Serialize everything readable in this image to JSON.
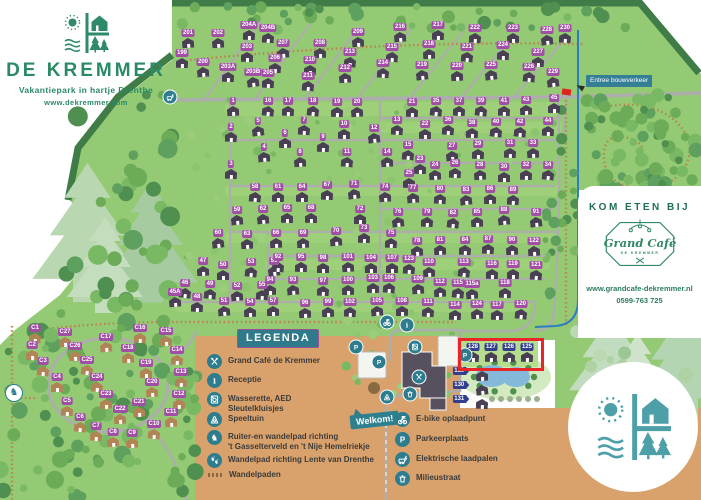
{
  "branding": {
    "logo_title": "DE KREMMER",
    "logo_subtitle": "Vakantiepark in hartje Drenthe",
    "logo_url": "www.dekremmer.com"
  },
  "cafe_panel": {
    "heading": "KOM ETEN BIJ",
    "logo_script": "Grand Café",
    "logo_sub": "DE KREMMER",
    "url": "www.grandcafe-dekremmer.nl",
    "phone": "0599-763 725"
  },
  "signs": {
    "welcome": "Welkom!",
    "entrance": "Entree bouwverkeer"
  },
  "legend": {
    "title": "LEGENDA",
    "items": [
      {
        "icon": "utensils-icon",
        "label": "Grand Café de Kremmer"
      },
      {
        "icon": "info-icon",
        "label": "Receptie"
      },
      {
        "icon": "washer-icon",
        "label": "Wasserette, AED\nSleutelkluisjes"
      },
      {
        "icon": "playground-icon",
        "label": "Speeltuin"
      },
      {
        "icon": "horse-icon",
        "label": "Ruiter-en wandelpad richting\n't Gasselterveld en 't Nije Hemelriekje"
      },
      {
        "icon": "footpath-icon",
        "label": "Wandelpad richting Lente van Drenthe"
      },
      {
        "icon": "trail-icon",
        "label": "Wandelpaden"
      }
    ],
    "items_right": [
      {
        "icon": "ebike-icon",
        "label": "E-bike oplaadpunt"
      },
      {
        "icon": "parking-icon",
        "label": "Parkeerplaats"
      },
      {
        "icon": "charger-icon",
        "label": "Elektrische laadpalen"
      },
      {
        "icon": "waste-icon",
        "label": "Milieustraat"
      }
    ]
  },
  "map": {
    "colors": {
      "green": "#94ca73",
      "dark_edge": "#3f7c47",
      "tan": "#d9a26c",
      "label_purple": "#a14fa5",
      "label_blue": "#333f8e",
      "house_dark": "#494153",
      "house_tan": "#b08455",
      "teal": "#2d7d8e",
      "red": "#e8262a",
      "route_blue": "#2e7fc2"
    },
    "houses": [
      [
        "199",
        182,
        58
      ],
      [
        "200",
        203,
        67
      ],
      [
        "201",
        188,
        38
      ],
      [
        "202",
        218,
        38
      ],
      [
        "203",
        247,
        52
      ],
      [
        "203A",
        228,
        72
      ],
      [
        "203B",
        253,
        77
      ],
      [
        "204A",
        249,
        30
      ],
      [
        "204B",
        268,
        33
      ],
      [
        "205",
        268,
        78
      ],
      [
        "206",
        275,
        63
      ],
      [
        "207",
        283,
        48
      ],
      [
        "208",
        320,
        48
      ],
      [
        "209",
        358,
        37
      ],
      [
        "210",
        310,
        65
      ],
      [
        "211",
        308,
        81
      ],
      [
        "212",
        345,
        73
      ],
      [
        "213",
        350,
        57
      ],
      [
        "214",
        383,
        68
      ],
      [
        "215",
        392,
        52
      ],
      [
        "216",
        400,
        32
      ],
      [
        "217",
        438,
        30
      ],
      [
        "218",
        429,
        49
      ],
      [
        "219",
        422,
        70
      ],
      [
        "220",
        457,
        71
      ],
      [
        "221",
        467,
        52
      ],
      [
        "222",
        475,
        33
      ],
      [
        "223",
        513,
        33
      ],
      [
        "224",
        503,
        50
      ],
      [
        "225",
        491,
        70
      ],
      [
        "226",
        529,
        72
      ],
      [
        "227",
        538,
        57
      ],
      [
        "228",
        547,
        35
      ],
      [
        "229",
        553,
        77
      ],
      [
        "230",
        565,
        33
      ],
      [
        "1",
        233,
        106
      ],
      [
        "16",
        268,
        106
      ],
      [
        "17",
        288,
        106
      ],
      [
        "18",
        313,
        106
      ],
      [
        "19",
        337,
        107
      ],
      [
        "20",
        357,
        107
      ],
      [
        "2",
        231,
        132
      ],
      [
        "5",
        258,
        126
      ],
      [
        "7",
        304,
        125
      ],
      [
        "10",
        344,
        129
      ],
      [
        "12",
        374,
        133
      ],
      [
        "6",
        285,
        138
      ],
      [
        "9",
        323,
        142
      ],
      [
        "4",
        264,
        152
      ],
      [
        "8",
        300,
        157
      ],
      [
        "11",
        347,
        157
      ],
      [
        "3",
        231,
        169
      ],
      [
        "13",
        397,
        125
      ],
      [
        "14",
        387,
        157
      ],
      [
        "15",
        408,
        150
      ],
      [
        "21",
        412,
        107
      ],
      [
        "22",
        425,
        129
      ],
      [
        "23",
        420,
        164
      ],
      [
        "24",
        435,
        170
      ],
      [
        "25",
        409,
        178
      ],
      [
        "26",
        455,
        168
      ],
      [
        "27",
        452,
        151
      ],
      [
        "28",
        480,
        170
      ],
      [
        "29",
        478,
        149
      ],
      [
        "30",
        504,
        172
      ],
      [
        "31",
        510,
        148
      ],
      [
        "32",
        526,
        170
      ],
      [
        "33",
        533,
        148
      ],
      [
        "34",
        548,
        170
      ],
      [
        "35",
        436,
        106
      ],
      [
        "36",
        448,
        125
      ],
      [
        "37",
        459,
        106
      ],
      [
        "38",
        472,
        128
      ],
      [
        "39",
        481,
        106
      ],
      [
        "40",
        496,
        127
      ],
      [
        "41",
        504,
        106
      ],
      [
        "42",
        520,
        127
      ],
      [
        "43",
        526,
        105
      ],
      [
        "44",
        548,
        126
      ],
      [
        "45",
        554,
        103
      ],
      [
        "45A",
        175,
        297
      ],
      [
        "46",
        185,
        288
      ],
      [
        "47",
        203,
        266
      ],
      [
        "48",
        197,
        302
      ],
      [
        "49",
        210,
        289
      ],
      [
        "50",
        223,
        270
      ],
      [
        "51",
        224,
        306
      ],
      [
        "52",
        237,
        291
      ],
      [
        "53",
        251,
        267
      ],
      [
        "54",
        250,
        307
      ],
      [
        "55",
        262,
        290
      ],
      [
        "56",
        274,
        266
      ],
      [
        "57",
        273,
        306
      ],
      [
        "58",
        255,
        192
      ],
      [
        "59",
        237,
        215
      ],
      [
        "60",
        218,
        238
      ],
      [
        "61",
        278,
        192
      ],
      [
        "62",
        263,
        214
      ],
      [
        "63",
        247,
        239
      ],
      [
        "64",
        302,
        192
      ],
      [
        "65",
        287,
        213
      ],
      [
        "66",
        276,
        238
      ],
      [
        "67",
        327,
        190
      ],
      [
        "68",
        311,
        213
      ],
      [
        "69",
        303,
        238
      ],
      [
        "70",
        336,
        236
      ],
      [
        "71",
        354,
        189
      ],
      [
        "72",
        360,
        214
      ],
      [
        "73",
        364,
        233
      ],
      [
        "74",
        385,
        192
      ],
      [
        "75",
        391,
        238
      ],
      [
        "76",
        398,
        217
      ],
      [
        "77",
        413,
        193
      ],
      [
        "78",
        417,
        246
      ],
      [
        "79",
        427,
        217
      ],
      [
        "80",
        440,
        194
      ],
      [
        "81",
        440,
        245
      ],
      [
        "82",
        453,
        218
      ],
      [
        "83",
        466,
        195
      ],
      [
        "84",
        465,
        245
      ],
      [
        "85",
        477,
        217
      ],
      [
        "86",
        490,
        194
      ],
      [
        "87",
        488,
        244
      ],
      [
        "88",
        504,
        215
      ],
      [
        "89",
        513,
        195
      ],
      [
        "90",
        512,
        245
      ],
      [
        "91",
        536,
        217
      ],
      [
        "92",
        278,
        262
      ],
      [
        "93",
        293,
        285
      ],
      [
        "94",
        270,
        285
      ],
      [
        "95",
        301,
        262
      ],
      [
        "96",
        305,
        308
      ],
      [
        "97",
        323,
        286
      ],
      [
        "98",
        323,
        263
      ],
      [
        "99",
        328,
        307
      ],
      [
        "100",
        348,
        285
      ],
      [
        "101",
        348,
        262
      ],
      [
        "102",
        350,
        307
      ],
      [
        "103",
        373,
        283
      ],
      [
        "104",
        371,
        263
      ],
      [
        "105",
        377,
        306
      ],
      [
        "106",
        389,
        283
      ],
      [
        "107",
        392,
        263
      ],
      [
        "108",
        402,
        306
      ],
      [
        "109",
        418,
        284
      ],
      [
        "110",
        429,
        267
      ],
      [
        "111",
        428,
        307
      ],
      [
        "112",
        440,
        287
      ],
      [
        "113",
        464,
        267
      ],
      [
        "114",
        455,
        310
      ],
      [
        "115",
        458,
        288
      ],
      [
        "115a",
        472,
        289
      ],
      [
        "116",
        492,
        269
      ],
      [
        "117",
        497,
        310
      ],
      [
        "118",
        505,
        288
      ],
      [
        "119",
        513,
        269
      ],
      [
        "120",
        521,
        309
      ],
      [
        "121",
        536,
        270
      ],
      [
        "122",
        534,
        246
      ],
      [
        "123",
        409,
        264
      ],
      [
        "124",
        477,
        309
      ]
    ],
    "c_houses": [
      [
        "C1",
        35,
        333
      ],
      [
        "C2",
        32,
        350
      ],
      [
        "C3",
        43,
        366
      ],
      [
        "C4",
        57,
        382
      ],
      [
        "C5",
        67,
        406
      ],
      [
        "C6",
        80,
        422
      ],
      [
        "C7",
        96,
        431
      ],
      [
        "C8",
        113,
        437
      ],
      [
        "C9",
        132,
        438
      ],
      [
        "C10",
        154,
        429
      ],
      [
        "C11",
        171,
        417
      ],
      [
        "C12",
        179,
        399
      ],
      [
        "C13",
        181,
        377
      ],
      [
        "C14",
        177,
        355
      ],
      [
        "C15",
        166,
        336
      ],
      [
        "C16",
        140,
        333
      ],
      [
        "C17",
        106,
        342
      ],
      [
        "C18",
        128,
        353
      ],
      [
        "C19",
        146,
        368
      ],
      [
        "C20",
        152,
        387
      ],
      [
        "C21",
        139,
        407
      ],
      [
        "C22",
        120,
        414
      ],
      [
        "C23",
        106,
        399
      ],
      [
        "C24",
        97,
        382
      ],
      [
        "C25",
        87,
        365
      ],
      [
        "C26",
        75,
        351
      ],
      [
        "C27",
        65,
        337
      ]
    ],
    "highlight_houses": [
      [
        "128",
        473,
        352
      ],
      [
        "127",
        491,
        352
      ],
      [
        "126",
        509,
        352
      ],
      [
        "125",
        527,
        352
      ]
    ],
    "arrow_houses": [
      [
        "129",
        461,
        371,
        482,
        371
      ],
      [
        "130",
        461,
        385,
        482,
        385
      ],
      [
        "131",
        461,
        399,
        482,
        399
      ]
    ],
    "highlight_rect": {
      "x": 458,
      "y": 338,
      "w": 80,
      "h": 27
    },
    "markers": [
      {
        "icon": "ebike-icon",
        "x": 387,
        "y": 322
      },
      {
        "icon": "info-icon",
        "x": 407,
        "y": 325
      },
      {
        "icon": "washer-icon",
        "x": 415,
        "y": 347
      },
      {
        "icon": "parking-icon",
        "x": 356,
        "y": 347
      },
      {
        "icon": "parking-icon",
        "x": 379,
        "y": 362
      },
      {
        "icon": "parking-icon",
        "x": 465,
        "y": 355
      },
      {
        "icon": "utensils-icon",
        "x": 419,
        "y": 377
      },
      {
        "icon": "playground-icon",
        "x": 387,
        "y": 397
      },
      {
        "icon": "waste-icon",
        "x": 410,
        "y": 394
      },
      {
        "icon": "charger-icon",
        "x": 170,
        "y": 97
      },
      {
        "icon": "horse-icon",
        "x": 14,
        "y": 393,
        "variant": "light"
      }
    ]
  }
}
